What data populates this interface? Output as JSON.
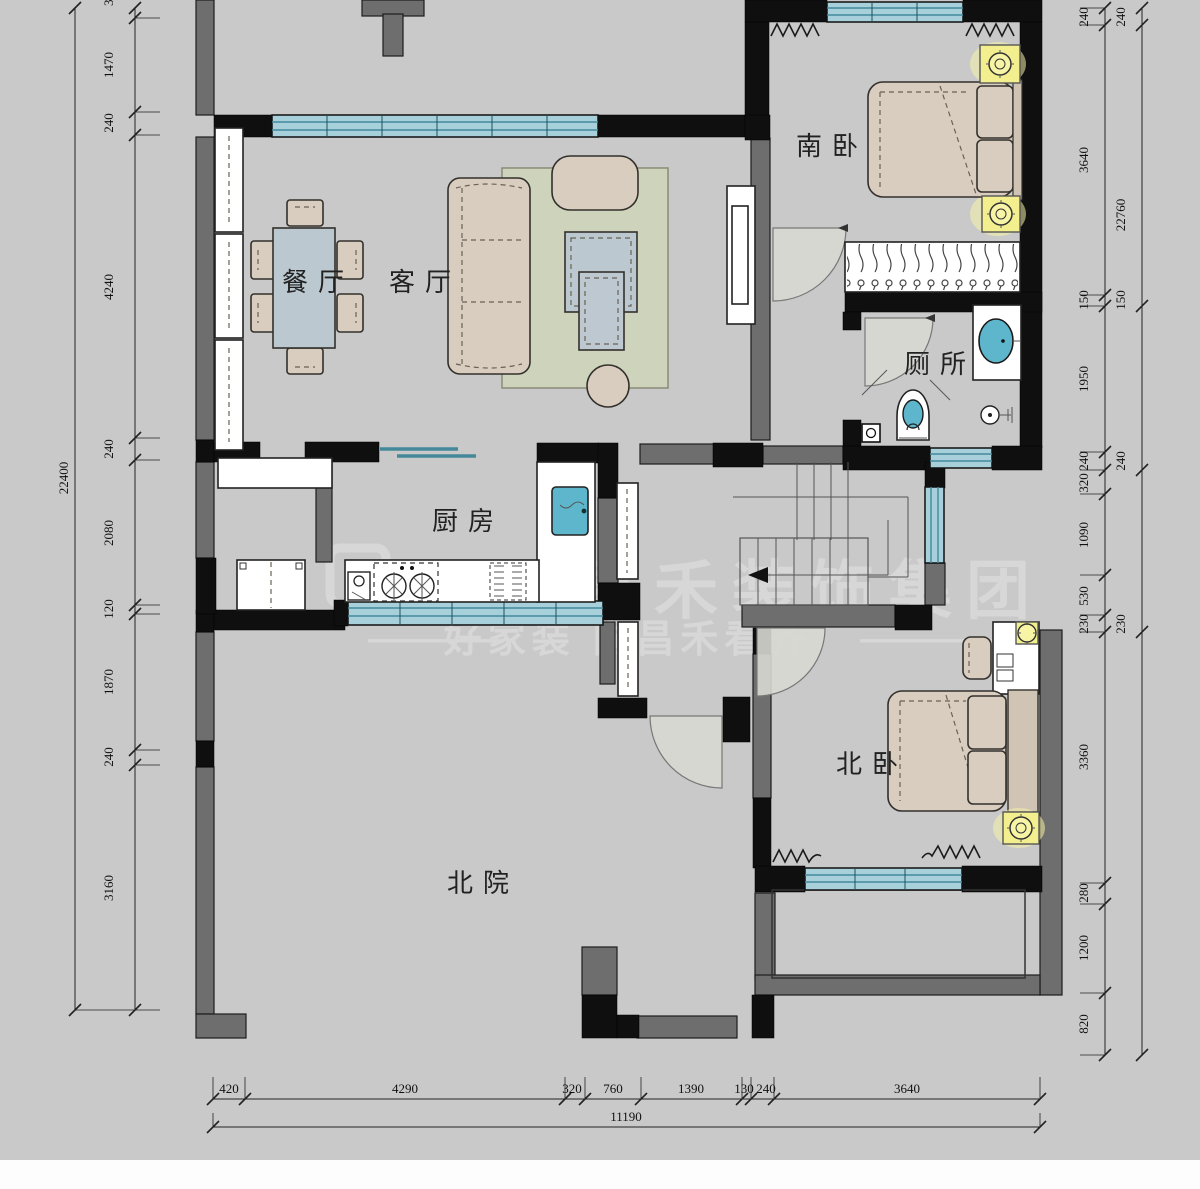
{
  "rooms": {
    "dining": "餐厅",
    "living": "客厅",
    "south_bedroom": "南卧",
    "toilet": "厕所",
    "kitchen": "厨房",
    "north_bedroom": "北卧",
    "north_yard": "北院"
  },
  "watermark": {
    "brand": "昌禾装饰集团",
    "tagline": "好家装 向昌禾看齐",
    "dash": "————"
  },
  "dims": {
    "left_overall": "22400",
    "left_clipped": "320",
    "left": [
      "1470",
      "240",
      "4240",
      "240",
      "2080",
      "120",
      "1870",
      "240",
      "3160"
    ],
    "right_inner": [
      "240",
      "3640",
      "150",
      "1950",
      "240",
      "320",
      "1090",
      "530",
      "230",
      "3360",
      "280",
      "1200",
      "820"
    ],
    "right_outer": [
      "240",
      "22760",
      "150",
      "240",
      "230"
    ],
    "bottom": [
      "420",
      "4290",
      "320",
      "760",
      "1390",
      "130",
      "240",
      "3640"
    ],
    "bottom_overall": "11190"
  },
  "colors": {
    "canvas": "#c9c9c9",
    "wall_black": "#0f0f0f",
    "wall_gray": "#6e6e6e",
    "window_blue": "#a7d0da",
    "furniture_beige": "#d9cdc0",
    "table_blue": "#bcc8d0",
    "rug_green": "#ced4bb",
    "accent_yellow": "#f3ef8e"
  }
}
